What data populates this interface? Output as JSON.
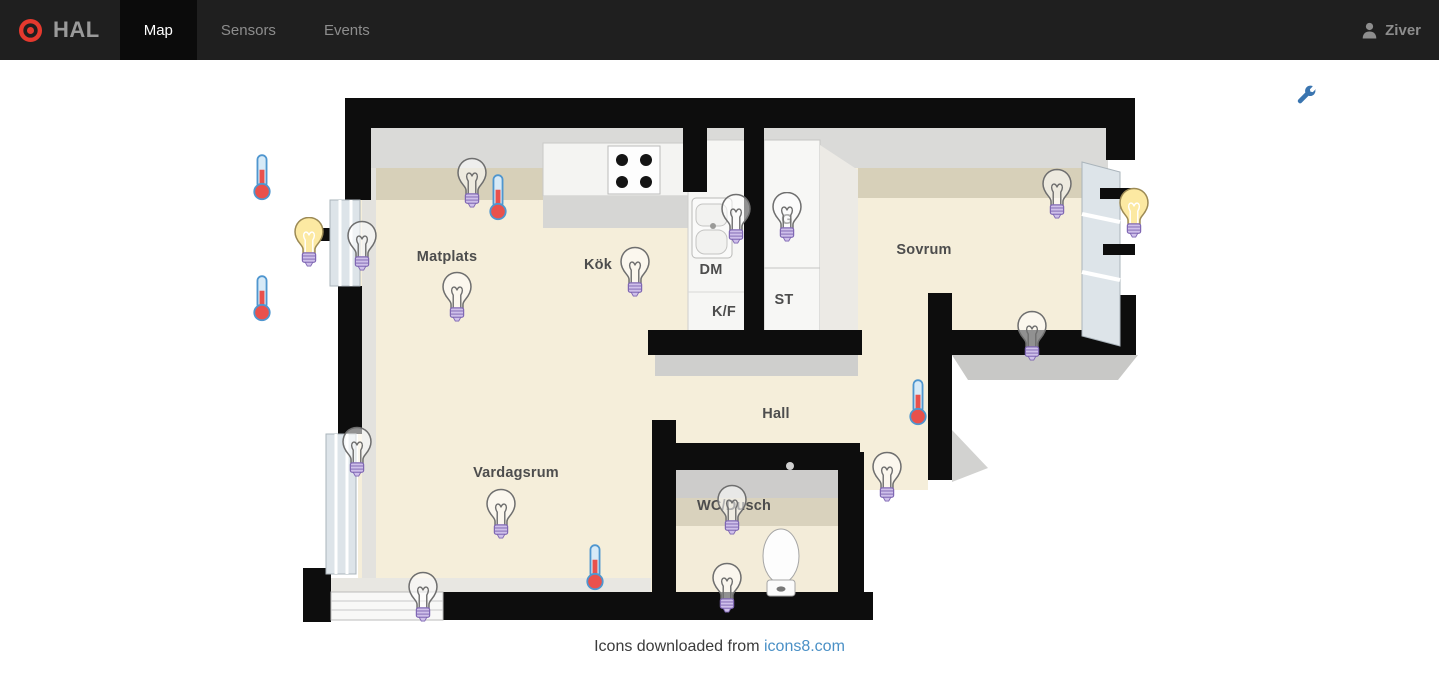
{
  "navbar": {
    "brand": "HAL",
    "tabs": [
      {
        "id": "map",
        "label": "Map",
        "active": true
      },
      {
        "id": "sensors",
        "label": "Sensors",
        "active": false
      },
      {
        "id": "events",
        "label": "Events",
        "active": false
      }
    ],
    "user": {
      "name": "Ziver"
    }
  },
  "map": {
    "rooms": [
      {
        "id": "matplats",
        "name": "Matplats",
        "x": 447,
        "y": 257
      },
      {
        "id": "kok",
        "name": "Kök",
        "x": 598,
        "y": 265
      },
      {
        "id": "dm",
        "name": "DM",
        "x": 711,
        "y": 270
      },
      {
        "id": "kf",
        "name": "K/F",
        "x": 724,
        "y": 312
      },
      {
        "id": "st",
        "name": "ST",
        "x": 784,
        "y": 300
      },
      {
        "id": "g",
        "name": "G",
        "x": 787,
        "y": 220
      },
      {
        "id": "sovrum",
        "name": "Sovrum",
        "x": 924,
        "y": 250
      },
      {
        "id": "hall",
        "name": "Hall",
        "x": 776,
        "y": 414
      },
      {
        "id": "vardagsrum",
        "name": "Vardagsrum",
        "x": 516,
        "y": 473
      },
      {
        "id": "wc-dusch",
        "name": "WC/Dusch",
        "x": 734,
        "y": 506
      }
    ],
    "bulbs": [
      {
        "id": "matplats-north",
        "x": 472,
        "y": 183,
        "on": false
      },
      {
        "id": "matplats-west",
        "x": 362,
        "y": 246,
        "on": false
      },
      {
        "id": "matplats-center",
        "x": 457,
        "y": 297,
        "on": false
      },
      {
        "id": "kok",
        "x": 635,
        "y": 272,
        "on": false
      },
      {
        "id": "kok-sink",
        "x": 736,
        "y": 219,
        "on": false
      },
      {
        "id": "closet-g",
        "x": 787,
        "y": 217,
        "on": false
      },
      {
        "id": "sovrum-north",
        "x": 1057,
        "y": 194,
        "on": false
      },
      {
        "id": "sovrum-south",
        "x": 1032,
        "y": 336,
        "on": false
      },
      {
        "id": "hall",
        "x": 887,
        "y": 477,
        "on": false
      },
      {
        "id": "wc-dusch",
        "x": 732,
        "y": 510,
        "on": false
      },
      {
        "id": "wc-dusch-south",
        "x": 727,
        "y": 588,
        "on": false
      },
      {
        "id": "vardagsrum-window",
        "x": 357,
        "y": 452,
        "on": false
      },
      {
        "id": "vardagsrum-center",
        "x": 501,
        "y": 514,
        "on": false
      },
      {
        "id": "vardagsrum-south",
        "x": 423,
        "y": 597,
        "on": false
      },
      {
        "id": "balcony-west",
        "x": 309,
        "y": 242,
        "on": true
      },
      {
        "id": "balcony-east",
        "x": 1134,
        "y": 213,
        "on": true
      }
    ],
    "thermometers": [
      {
        "id": "west-north",
        "x": 262,
        "y": 177
      },
      {
        "id": "west-south",
        "x": 262,
        "y": 298
      },
      {
        "id": "matplats",
        "x": 498,
        "y": 197
      },
      {
        "id": "hall",
        "x": 918,
        "y": 402
      },
      {
        "id": "vardagsrum",
        "x": 595,
        "y": 567
      }
    ]
  },
  "footer": {
    "text": "Icons downloaded from",
    "link_label": "icons8.com"
  },
  "colors": {
    "brand_red": "#e5392e",
    "link_blue": "#4a90c6",
    "bulb_on_yellow": "#fce9a2",
    "thermometer_red": "#e9514c",
    "wrench_blue": "#3a75b0"
  }
}
